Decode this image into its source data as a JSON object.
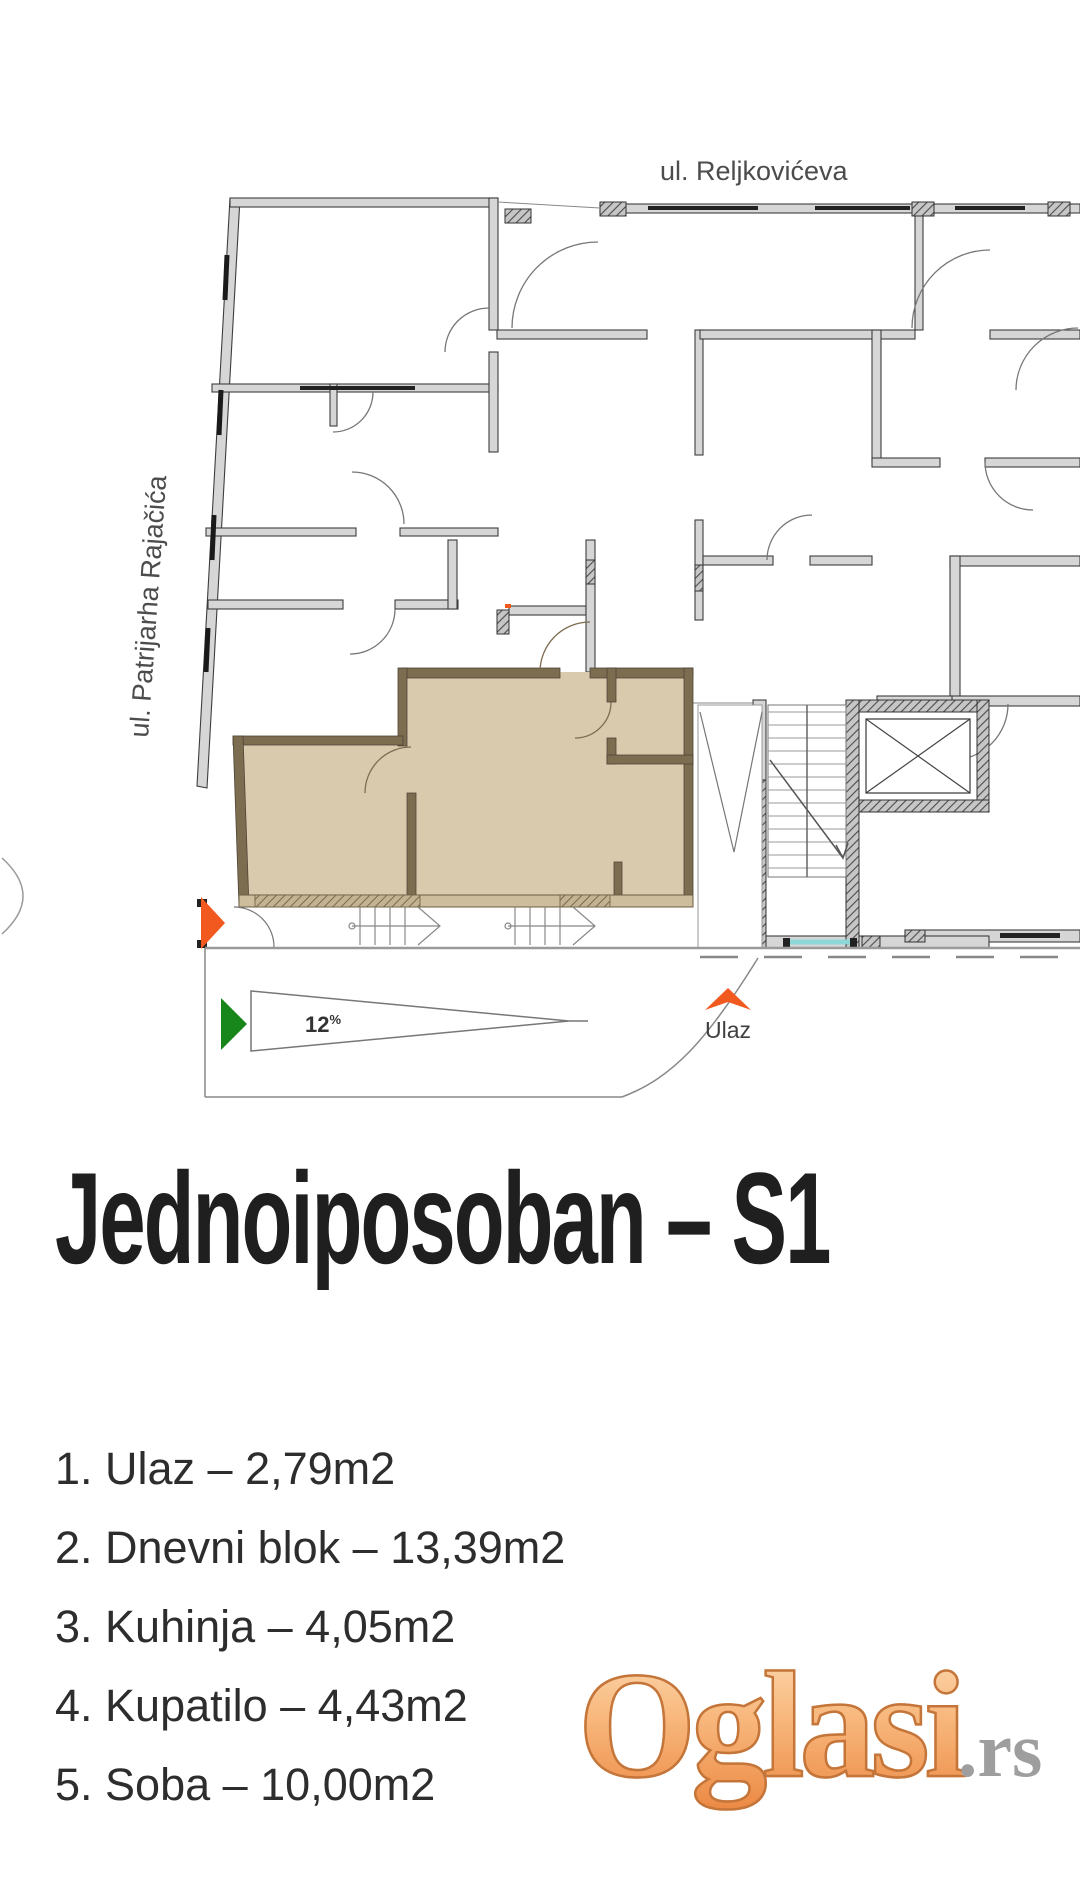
{
  "plan": {
    "street_top": "ul. Reljkovićeva",
    "street_left": "ul. Patrijarha Rajačića",
    "ramp_value": "12",
    "ramp_unit": "%",
    "entrance_label": "Ulaz"
  },
  "title": "Jednoiposoban – S1",
  "rooms": [
    {
      "label": "1. Ulaz – 2,79m2"
    },
    {
      "label": "2. Dnevni blok – 13,39m2"
    },
    {
      "label": "3. Kuhinja – 4,05m2"
    },
    {
      "label": "4. Kupatilo – 4,43m2"
    },
    {
      "label": "5. Soba – 10,00m2"
    }
  ],
  "watermark": {
    "brand": "Oglasi",
    "suffix": ".rs"
  },
  "colors": {
    "unit_highlight": "#d9c9ad",
    "unit_wall": "#7c6c50",
    "plan_wall": "#d6d6d6",
    "accent_orange": "#f2591f",
    "accent_green": "#17871c",
    "window_teal": "#8fd8d8"
  }
}
